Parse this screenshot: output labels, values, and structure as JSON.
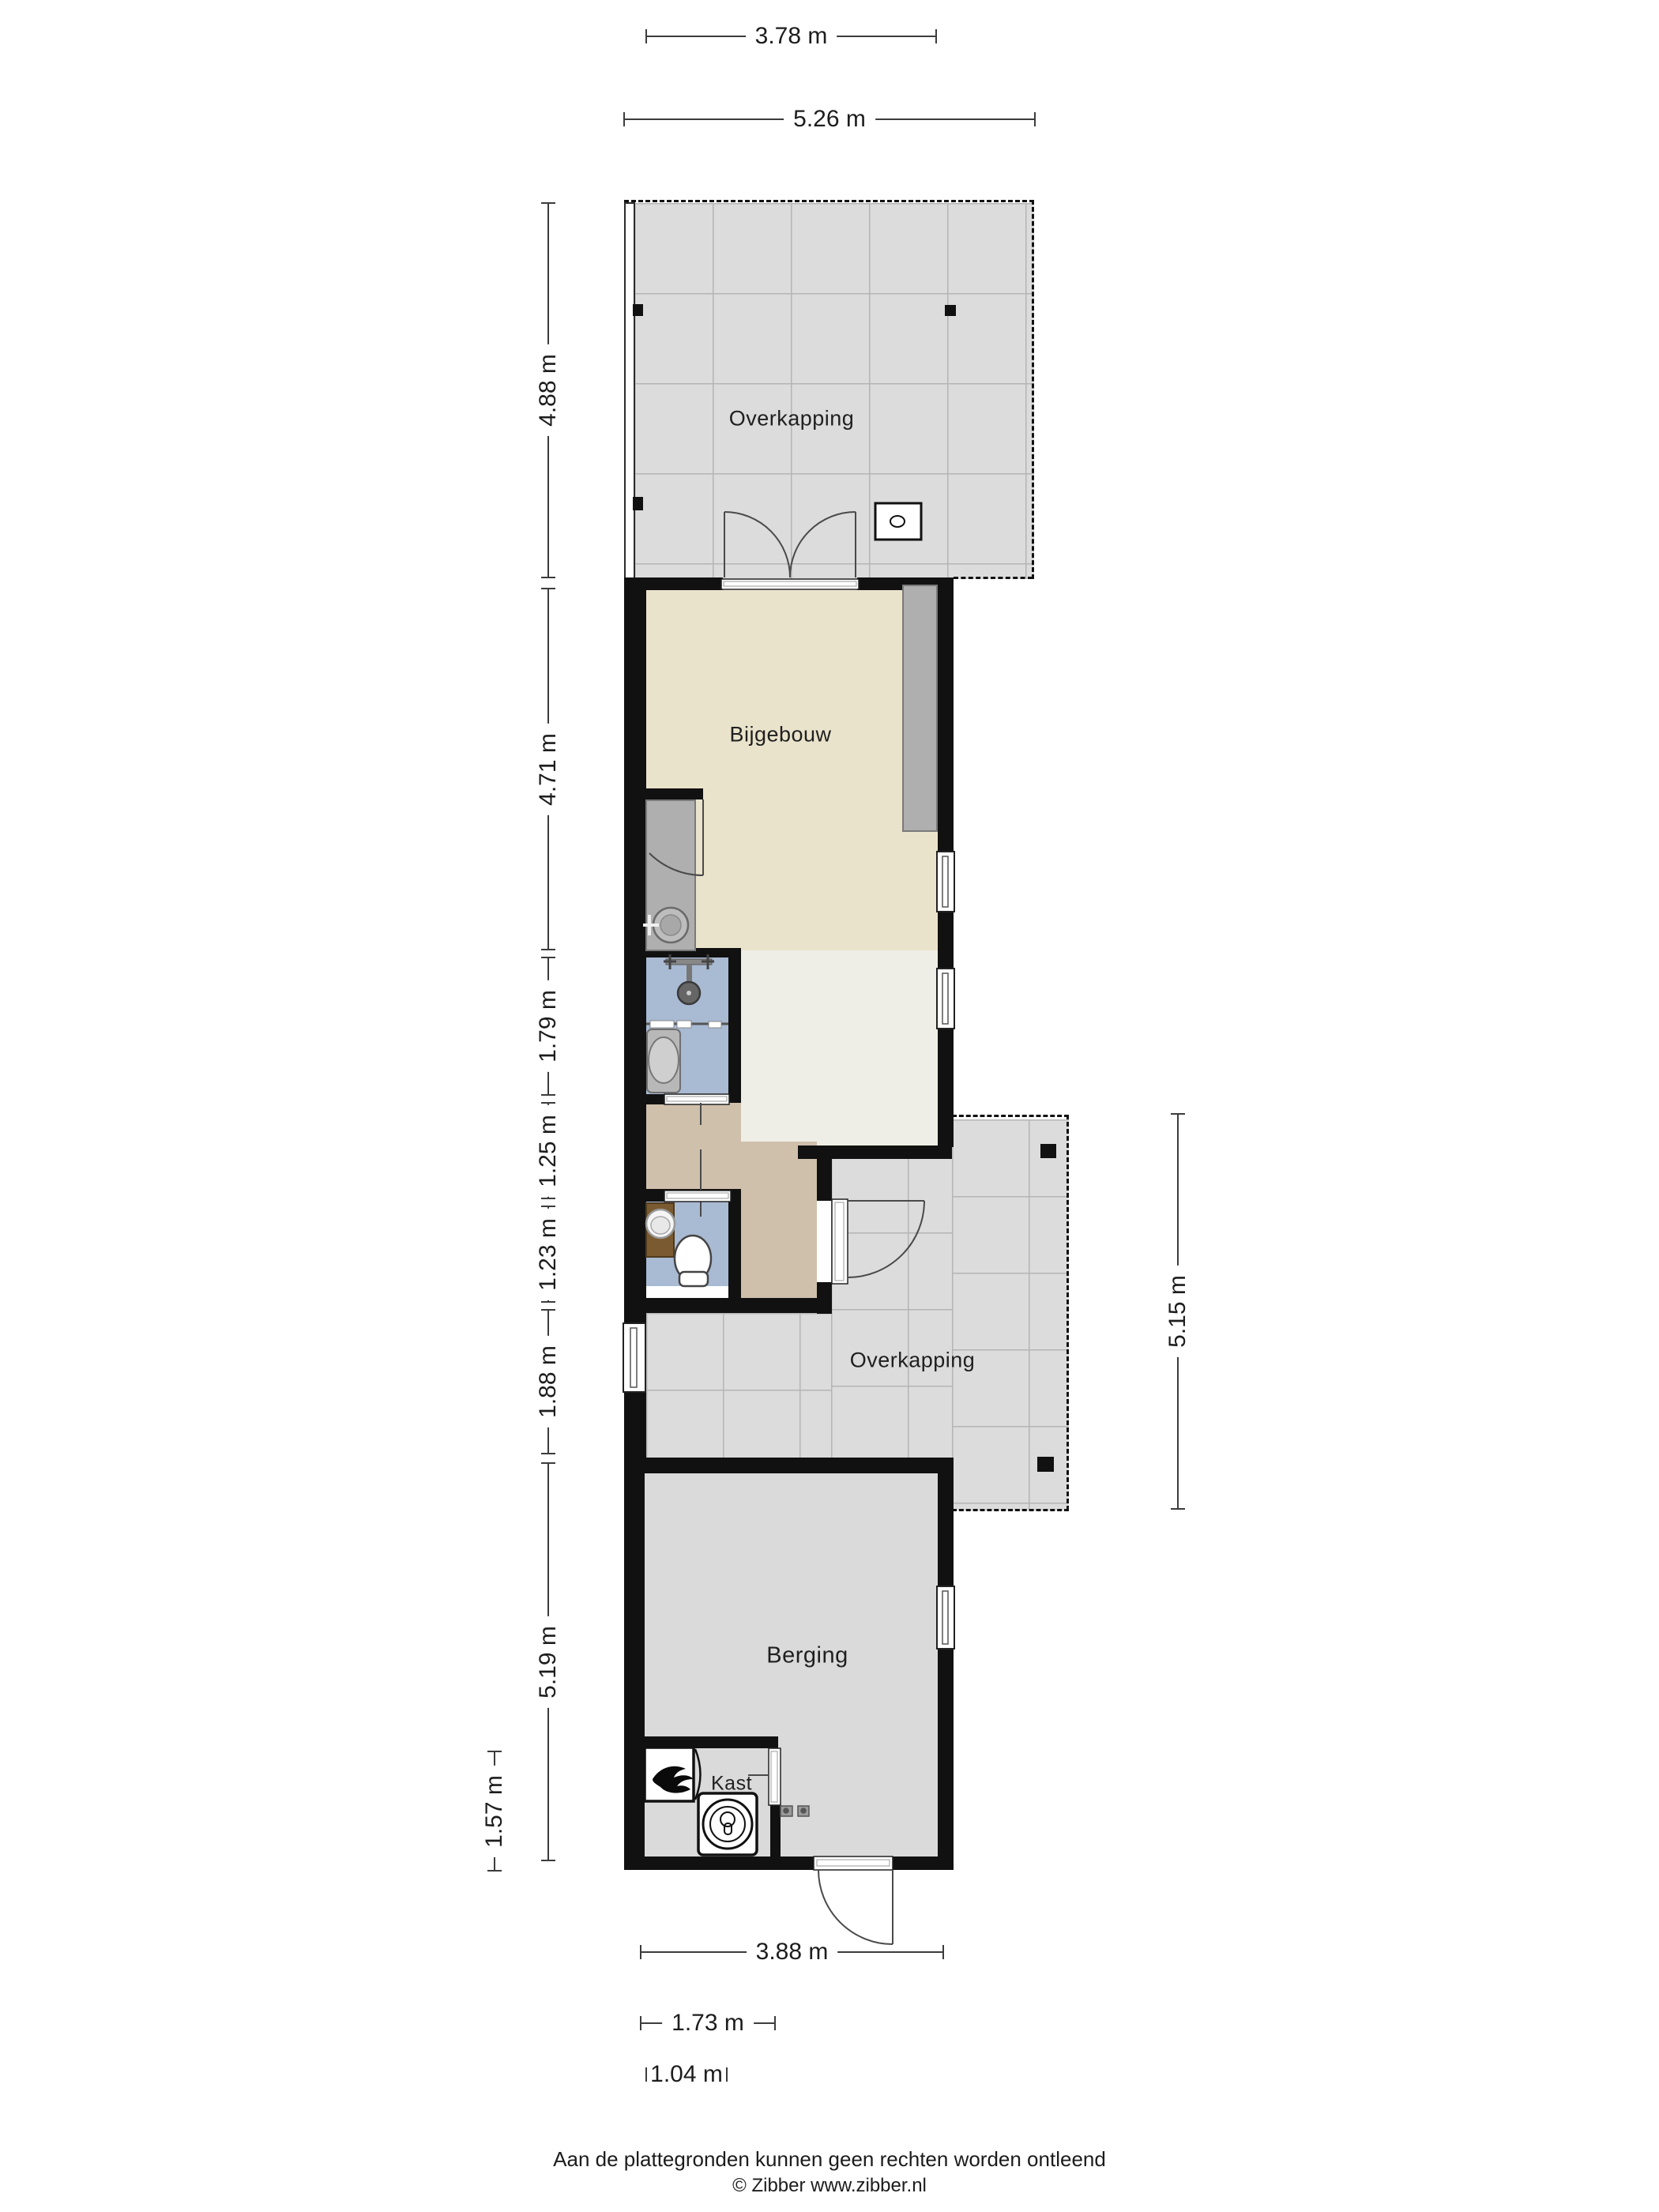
{
  "rooms": [
    {
      "id": "overkapping-top",
      "label": "Overkapping"
    },
    {
      "id": "bijgebouw",
      "label": "Bijgebouw"
    },
    {
      "id": "overkapping-middle",
      "label": "Overkapping"
    },
    {
      "id": "berging",
      "label": "Berging"
    },
    {
      "id": "kast",
      "label": "Kast"
    }
  ],
  "dimensions": {
    "top": [
      {
        "label": "3.78 m"
      },
      {
        "label": "5.26 m"
      }
    ],
    "left": [
      {
        "label": "4.88 m"
      },
      {
        "label": "4.71 m"
      },
      {
        "label": "1.79 m"
      },
      {
        "label": "1.25 m"
      },
      {
        "label": "1.23 m"
      },
      {
        "label": "1.88 m"
      },
      {
        "label": "5.19 m"
      },
      {
        "label": "1.57 m"
      }
    ],
    "right": [
      {
        "label": "5.15 m"
      }
    ],
    "bottom": [
      {
        "label": "3.88 m"
      },
      {
        "label": "1.73 m"
      },
      {
        "label": "1.04 m"
      }
    ]
  },
  "footer": {
    "line1": "Aan de plattegronden kunnen geen rechten worden ontleend",
    "line2": "© Zibber www.zibber.nl"
  },
  "colors": {
    "wall": "#111111",
    "tile": "#dcdcdc",
    "tileline": "#b5b5b5",
    "beige": "#eae3cc",
    "cream": "#efeee6",
    "tan": "#cfc0ac",
    "blue": "#a9bad3",
    "gray": "#dadada",
    "counter": "#afafaf",
    "wood": "#7a5a31"
  }
}
